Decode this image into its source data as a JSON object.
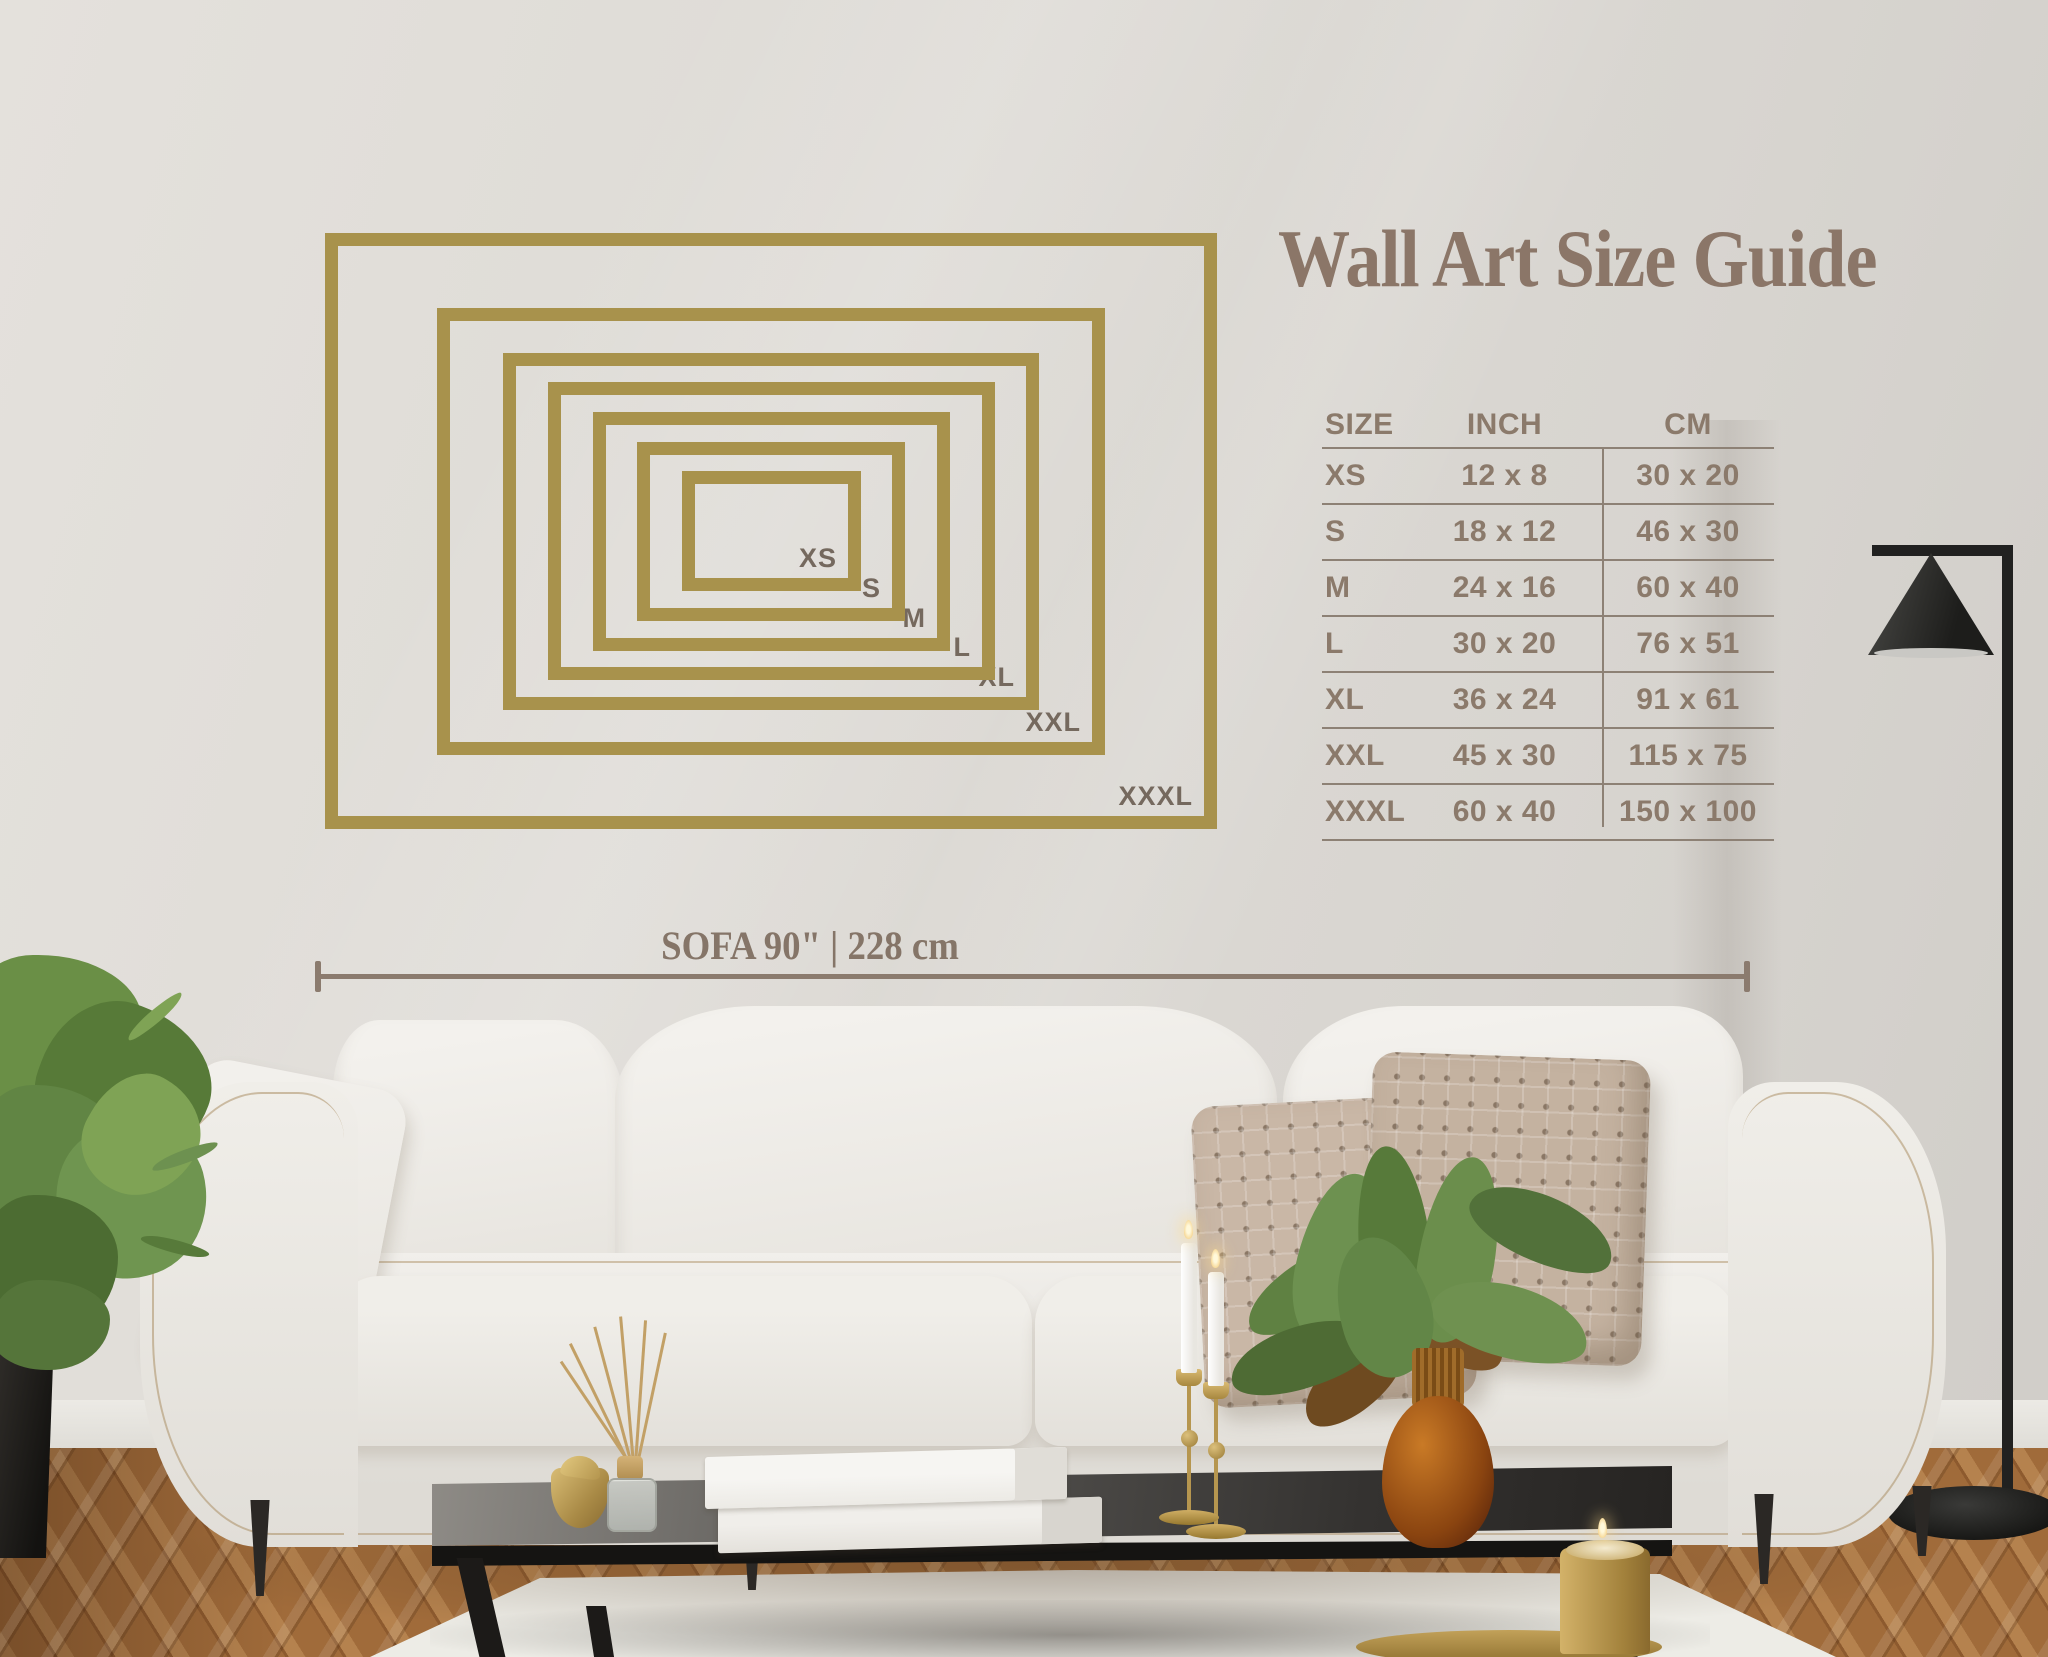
{
  "title": "Wall Art Size Guide",
  "diagram": {
    "frames": [
      {
        "label": "XS"
      },
      {
        "label": "S"
      },
      {
        "label": "M"
      },
      {
        "label": "L"
      },
      {
        "label": "XL"
      },
      {
        "label": "XXL"
      },
      {
        "label": "XXXL"
      }
    ]
  },
  "table": {
    "headers": {
      "size": "SIZE",
      "inch": "INCH",
      "cm": "CM"
    },
    "rows": [
      {
        "size": "XS",
        "inch": "12 x 8",
        "cm": "30 x 20"
      },
      {
        "size": "S",
        "inch": "18 x 12",
        "cm": "46 x 30"
      },
      {
        "size": "M",
        "inch": "24 x 16",
        "cm": "60 x 40"
      },
      {
        "size": "L",
        "inch": "30 x 20",
        "cm": "76 x 51"
      },
      {
        "size": "XL",
        "inch": "36 x 24",
        "cm": "91 x 61"
      },
      {
        "size": "XXL",
        "inch": "45 x 30",
        "cm": "115 x 75"
      },
      {
        "size": "XXXL",
        "inch": "60 x 40",
        "cm": "150 x 100"
      }
    ]
  },
  "measure": {
    "label": "SOFA 90\" | 228 cm"
  },
  "colors": {
    "frame_gold": "#a8924c",
    "title_brown": "#8b7668",
    "table_text": "#8b7a6b",
    "measure_line": "#8b7b6e",
    "wall": "#dedbd6"
  }
}
